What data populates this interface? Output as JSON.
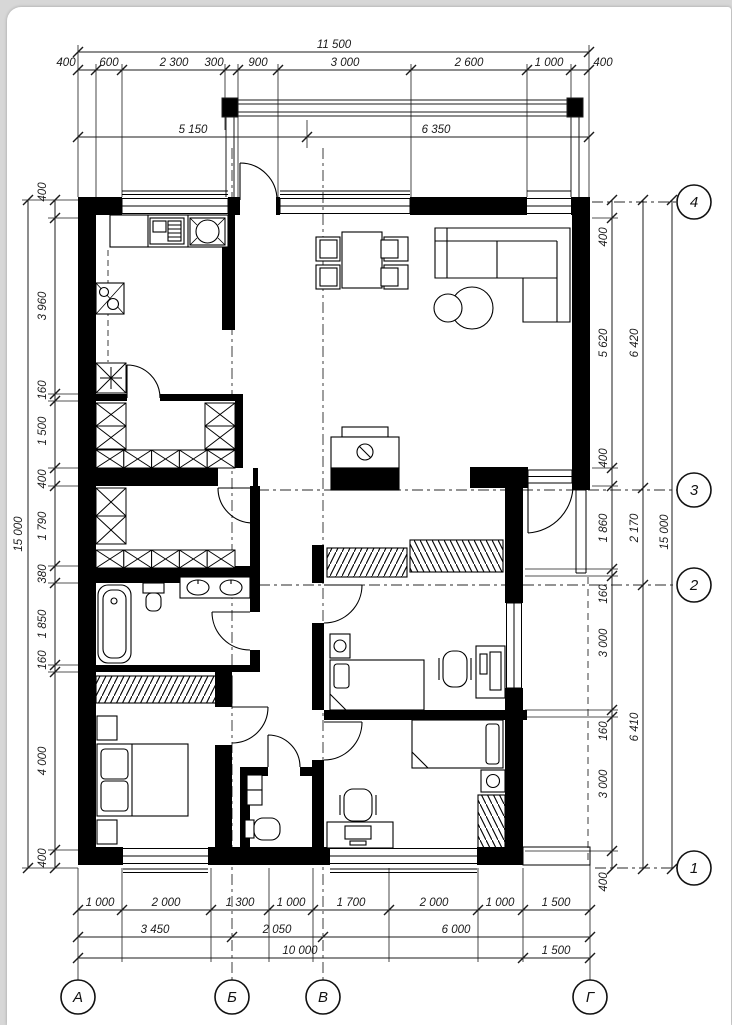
{
  "dimensions": {
    "top": {
      "total": "11 500",
      "sub": [
        "5 150",
        "6 350"
      ],
      "chain": [
        "400",
        "600",
        "2 300",
        "300",
        "900",
        "3 000",
        "2 600",
        "1 000",
        "400"
      ]
    },
    "left": {
      "total": "15 000",
      "chain": [
        "400",
        "3 960",
        "160",
        "1 500",
        "400",
        "1 790",
        "380",
        "1 850",
        "160",
        "4 000",
        "400"
      ]
    },
    "right": {
      "total": "15 000",
      "intermediate": [
        "6 420",
        "2 170",
        "6 410"
      ],
      "chain": [
        "400",
        "5 620",
        "400",
        "1 860",
        "160",
        "3 000",
        "160",
        "3 000",
        "400"
      ]
    },
    "bottom": {
      "chain": [
        "1 000",
        "2 000",
        "1 300",
        "1 000",
        "1 700",
        "2 000",
        "1 000",
        "1 500"
      ],
      "sub": [
        "3 450",
        "2 050",
        "6 000"
      ],
      "sub2": [
        "10 000",
        "1 500"
      ]
    }
  },
  "axes": {
    "vertical_labels": [
      "1",
      "2",
      "3",
      "4"
    ],
    "horizontal_labels": [
      "А",
      "Б",
      "В",
      "Г"
    ]
  },
  "dim_labels": [
    {
      "t": "11 500",
      "x": 334,
      "y": 48
    },
    {
      "t": "400",
      "x": 66,
      "y": 66
    },
    {
      "t": "600",
      "x": 109,
      "y": 66
    },
    {
      "t": "2 300",
      "x": 174,
      "y": 66
    },
    {
      "t": "300",
      "x": 214,
      "y": 66
    },
    {
      "t": "900",
      "x": 258,
      "y": 66
    },
    {
      "t": "3 000",
      "x": 345,
      "y": 66
    },
    {
      "t": "2 600",
      "x": 469,
      "y": 66
    },
    {
      "t": "1 000",
      "x": 549,
      "y": 66
    },
    {
      "t": "400",
      "x": 603,
      "y": 66
    },
    {
      "t": "5 150",
      "x": 193,
      "y": 133
    },
    {
      "t": "6 350",
      "x": 436,
      "y": 133
    },
    {
      "t": "400",
      "x": 46,
      "y": 192,
      "r": -90
    },
    {
      "t": "3 960",
      "x": 46,
      "y": 306,
      "r": -90
    },
    {
      "t": "160",
      "x": 46,
      "y": 390,
      "r": -90
    },
    {
      "t": "1 500",
      "x": 46,
      "y": 431,
      "r": -90
    },
    {
      "t": "400",
      "x": 46,
      "y": 479,
      "r": -90
    },
    {
      "t": "1 790",
      "x": 46,
      "y": 526,
      "r": -90
    },
    {
      "t": "380",
      "x": 46,
      "y": 574,
      "r": -90
    },
    {
      "t": "1 850",
      "x": 46,
      "y": 624,
      "r": -90
    },
    {
      "t": "160",
      "x": 46,
      "y": 660,
      "r": -90
    },
    {
      "t": "4 000",
      "x": 46,
      "y": 761,
      "r": -90
    },
    {
      "t": "400",
      "x": 46,
      "y": 858,
      "r": -90
    },
    {
      "t": "15 000",
      "x": 22,
      "y": 534,
      "r": -90
    },
    {
      "t": "400",
      "x": 607,
      "y": 237,
      "r": -90
    },
    {
      "t": "5 620",
      "x": 607,
      "y": 343,
      "r": -90
    },
    {
      "t": "400",
      "x": 607,
      "y": 458,
      "r": -90
    },
    {
      "t": "1 860",
      "x": 607,
      "y": 528,
      "r": -90
    },
    {
      "t": "160",
      "x": 607,
      "y": 594,
      "r": -90
    },
    {
      "t": "3 000",
      "x": 607,
      "y": 643,
      "r": -90
    },
    {
      "t": "160",
      "x": 607,
      "y": 731,
      "r": -90
    },
    {
      "t": "3 000",
      "x": 607,
      "y": 784,
      "r": -90
    },
    {
      "t": "400",
      "x": 607,
      "y": 882,
      "r": -90
    },
    {
      "t": "6 420",
      "x": 638,
      "y": 343,
      "r": -90
    },
    {
      "t": "2 170",
      "x": 638,
      "y": 528,
      "r": -90
    },
    {
      "t": "6 410",
      "x": 638,
      "y": 727,
      "r": -90
    },
    {
      "t": "15 000",
      "x": 668,
      "y": 532,
      "r": -90
    },
    {
      "t": "1 000",
      "x": 100,
      "y": 906
    },
    {
      "t": "2 000",
      "x": 166,
      "y": 906
    },
    {
      "t": "1 300",
      "x": 240,
      "y": 906
    },
    {
      "t": "1 000",
      "x": 291,
      "y": 906
    },
    {
      "t": "1 700",
      "x": 351,
      "y": 906
    },
    {
      "t": "2 000",
      "x": 434,
      "y": 906
    },
    {
      "t": "1 000",
      "x": 500,
      "y": 906
    },
    {
      "t": "1 500",
      "x": 556,
      "y": 906
    },
    {
      "t": "3 450",
      "x": 155,
      "y": 933
    },
    {
      "t": "2 050",
      "x": 277,
      "y": 933
    },
    {
      "t": "6 000",
      "x": 456,
      "y": 933
    },
    {
      "t": "10 000",
      "x": 300,
      "y": 954
    },
    {
      "t": "1 500",
      "x": 556,
      "y": 954
    }
  ],
  "axis_bubbles": [
    {
      "label": "4",
      "x": 694,
      "y": 202
    },
    {
      "label": "3",
      "x": 694,
      "y": 490
    },
    {
      "label": "2",
      "x": 694,
      "y": 585
    },
    {
      "label": "1",
      "x": 694,
      "y": 868
    },
    {
      "label": "А",
      "x": 78,
      "y": 997
    },
    {
      "label": "Б",
      "x": 232,
      "y": 997
    },
    {
      "label": "В",
      "x": 323,
      "y": 997
    },
    {
      "label": "Г",
      "x": 590,
      "y": 997
    }
  ]
}
